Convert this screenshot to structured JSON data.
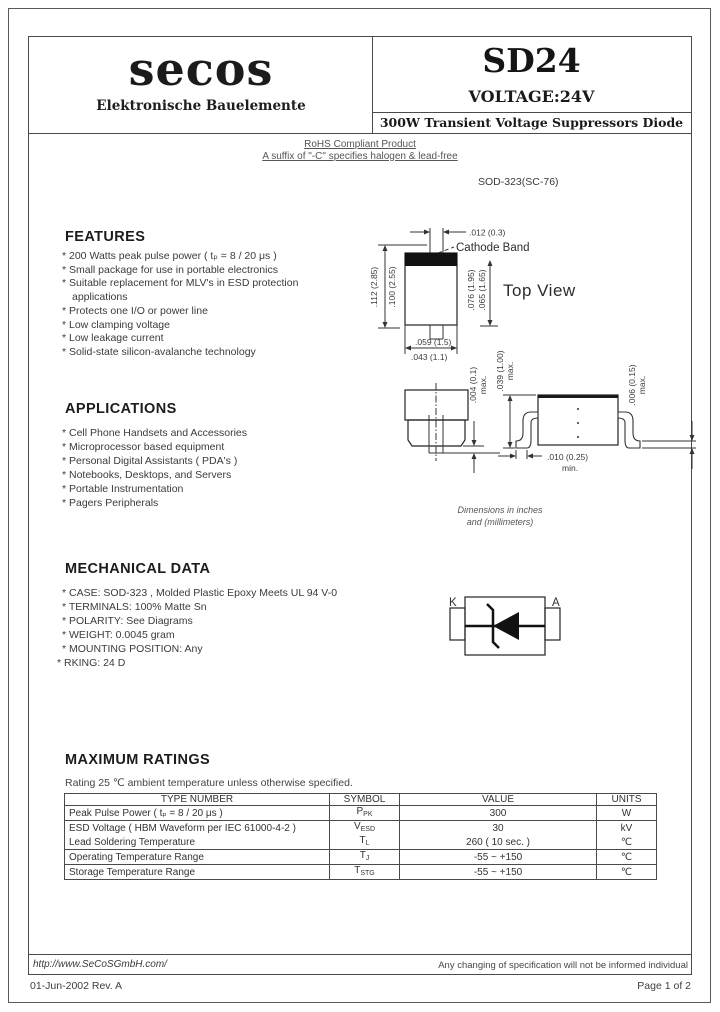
{
  "header": {
    "logo": {
      "s1": "s",
      "e": "e",
      "rest": "cos"
    },
    "logo_subtitle": "Elektronische Bauelemente",
    "part_number": "SD24",
    "voltage": "VOLTAGE:24V",
    "description": "300W Transient Voltage Suppressors Diode"
  },
  "rohs": {
    "line1": "RoHS Compliant Product",
    "line2": "A suffix of \"-C\" specifies halogen & lead-free"
  },
  "package_name": "SOD-323(SC-76)",
  "features": {
    "title": "FEATURES",
    "items": [
      "* 200 Watts peak pulse power ( tₚ = 8 / 20 μs )",
      "* Small package for use in portable electronics",
      "* Suitable replacement for MLV's in ESD protection",
      "applications",
      "* Protects one I/O or power line",
      "* Low clamping voltage",
      "* Low leakage current",
      "* Solid-state silicon-avalanche technology"
    ]
  },
  "applications": {
    "title": "APPLICATIONS",
    "items": [
      "* Cell Phone Handsets and Accessories",
      "* Microprocessor based equipment",
      "* Personal Digital Assistants ( PDA's )",
      "* Notebooks, Desktops, and Servers",
      "* Portable Instrumentation",
      "* Pagers Peripherals"
    ]
  },
  "mechanical": {
    "title": "MECHANICAL DATA",
    "items": [
      "* CASE: SOD-323 , Molded Plastic Epoxy Meets UL 94 V-0",
      "* TERMINALS: 100% Matte Sn",
      "* POLARITY: See Diagrams",
      "* WEIGHT: 0.0045 gram",
      "* MOUNTING POSITION: Any",
      "* RKING: 24 D"
    ]
  },
  "drawing": {
    "cathode_band": "Cathode Band",
    "top_view": "Top View",
    "dim_lead_width": ".012 (0.3)",
    "dim_length_max": ".112 (2.85)",
    "dim_length_min": ".100 (2.55)",
    "dim_body_max": ".076 (1.95)",
    "dim_body_min": ".065 (1.65)",
    "dim_width_max": ".059 (1.5)",
    "dim_width_min": ".043 (1.1)",
    "dim_standoff": ".004 (0.1)",
    "dim_height": ".039 (1.00)",
    "dim_lead_thickness": ".006 (0.15)",
    "dim_foot_length": ".010 (0.25)",
    "max_label1": "max.",
    "max_label2": "max.",
    "max_label3": "max.",
    "min_label": "min.",
    "note_line1": "Dimensions in inches",
    "note_line2": "and (millimeters)",
    "cathode_pin": "K",
    "anode_pin": "A"
  },
  "ratings": {
    "title": "MAXIMUM RATINGS",
    "note": "Rating 25 ℃ ambient temperature unless otherwise specified.",
    "headers": [
      "TYPE NUMBER",
      "SYMBOL",
      "VALUE",
      "UNITS"
    ],
    "rows": [
      {
        "type": "Peak Pulse Power ( tₚ = 8 / 20 μs )",
        "sym": "P",
        "sym_sub": "PK",
        "value": "300",
        "units": "W"
      },
      {
        "type": "ESD Voltage ( HBM Waveform per IEC 61000-4-2 )",
        "sym": "V",
        "sym_sub": "ESD",
        "value": "30",
        "units": "kV"
      },
      {
        "type": "Lead Soldering Temperature",
        "sym": "T",
        "sym_sub": "L",
        "value": "260 ( 10 sec. )",
        "units": "℃"
      },
      {
        "type": "Operating Temperature Range",
        "sym": "T",
        "sym_sub": "J",
        "value": "-55 ~ +150",
        "units": "℃"
      },
      {
        "type": "Storage Temperature Range",
        "sym": "T",
        "sym_sub": "STG",
        "value": "-55 ~ +150",
        "units": "℃"
      }
    ]
  },
  "footer": {
    "url": "http://www.SeCoSGmbH.com/",
    "disclaimer": "Any changing of specification will not be informed individual",
    "date_rev": "01-Jun-2002 Rev. A",
    "page": "Page 1 of 2"
  }
}
